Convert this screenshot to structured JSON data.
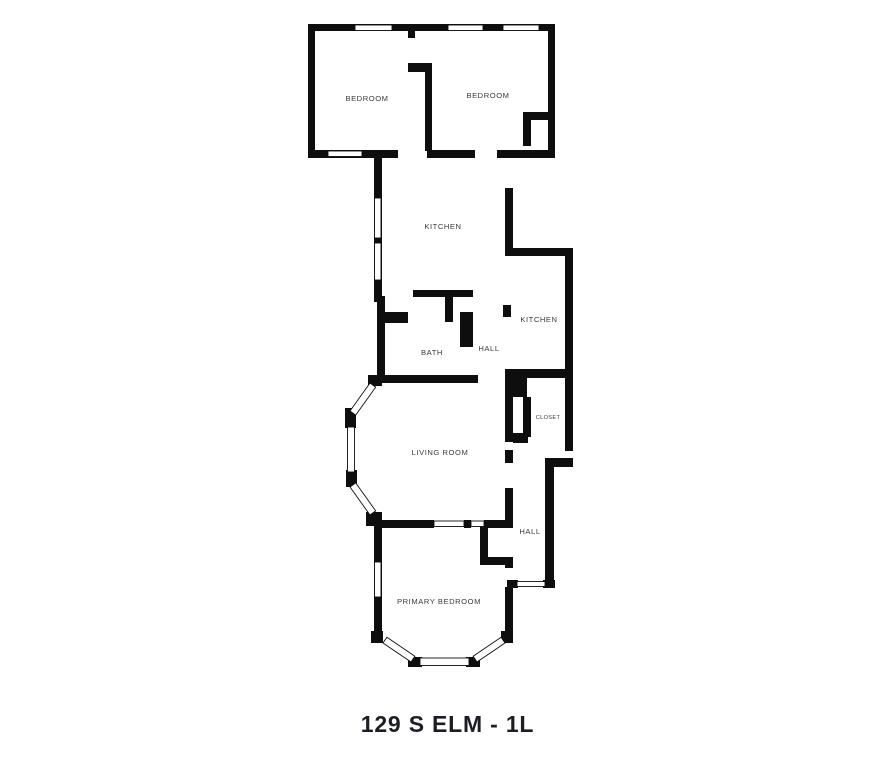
{
  "page": {
    "background_color": "#ffffff"
  },
  "plan": {
    "colors": {
      "wall": "#0e0e0e",
      "room_label": "#3a3a3a",
      "caption": "#1d1d25"
    },
    "rooms": [
      {
        "id": "bedroom-left",
        "label": "BEDROOM"
      },
      {
        "id": "bedroom-right",
        "label": "BEDROOM"
      },
      {
        "id": "kitchen-main",
        "label": "KITCHEN"
      },
      {
        "id": "kitchen-right",
        "label": "KITCHEN"
      },
      {
        "id": "bath",
        "label": "BATH"
      },
      {
        "id": "hall-middle",
        "label": "HALL"
      },
      {
        "id": "living-room",
        "label": "LIVING ROOM"
      },
      {
        "id": "closet",
        "label": "CLOSET"
      },
      {
        "id": "hall-lower",
        "label": "HALL"
      },
      {
        "id": "primary-bedroom",
        "label": "PRIMARY BEDROOM"
      }
    ]
  },
  "caption": {
    "text": "129 S ELM - 1L"
  }
}
